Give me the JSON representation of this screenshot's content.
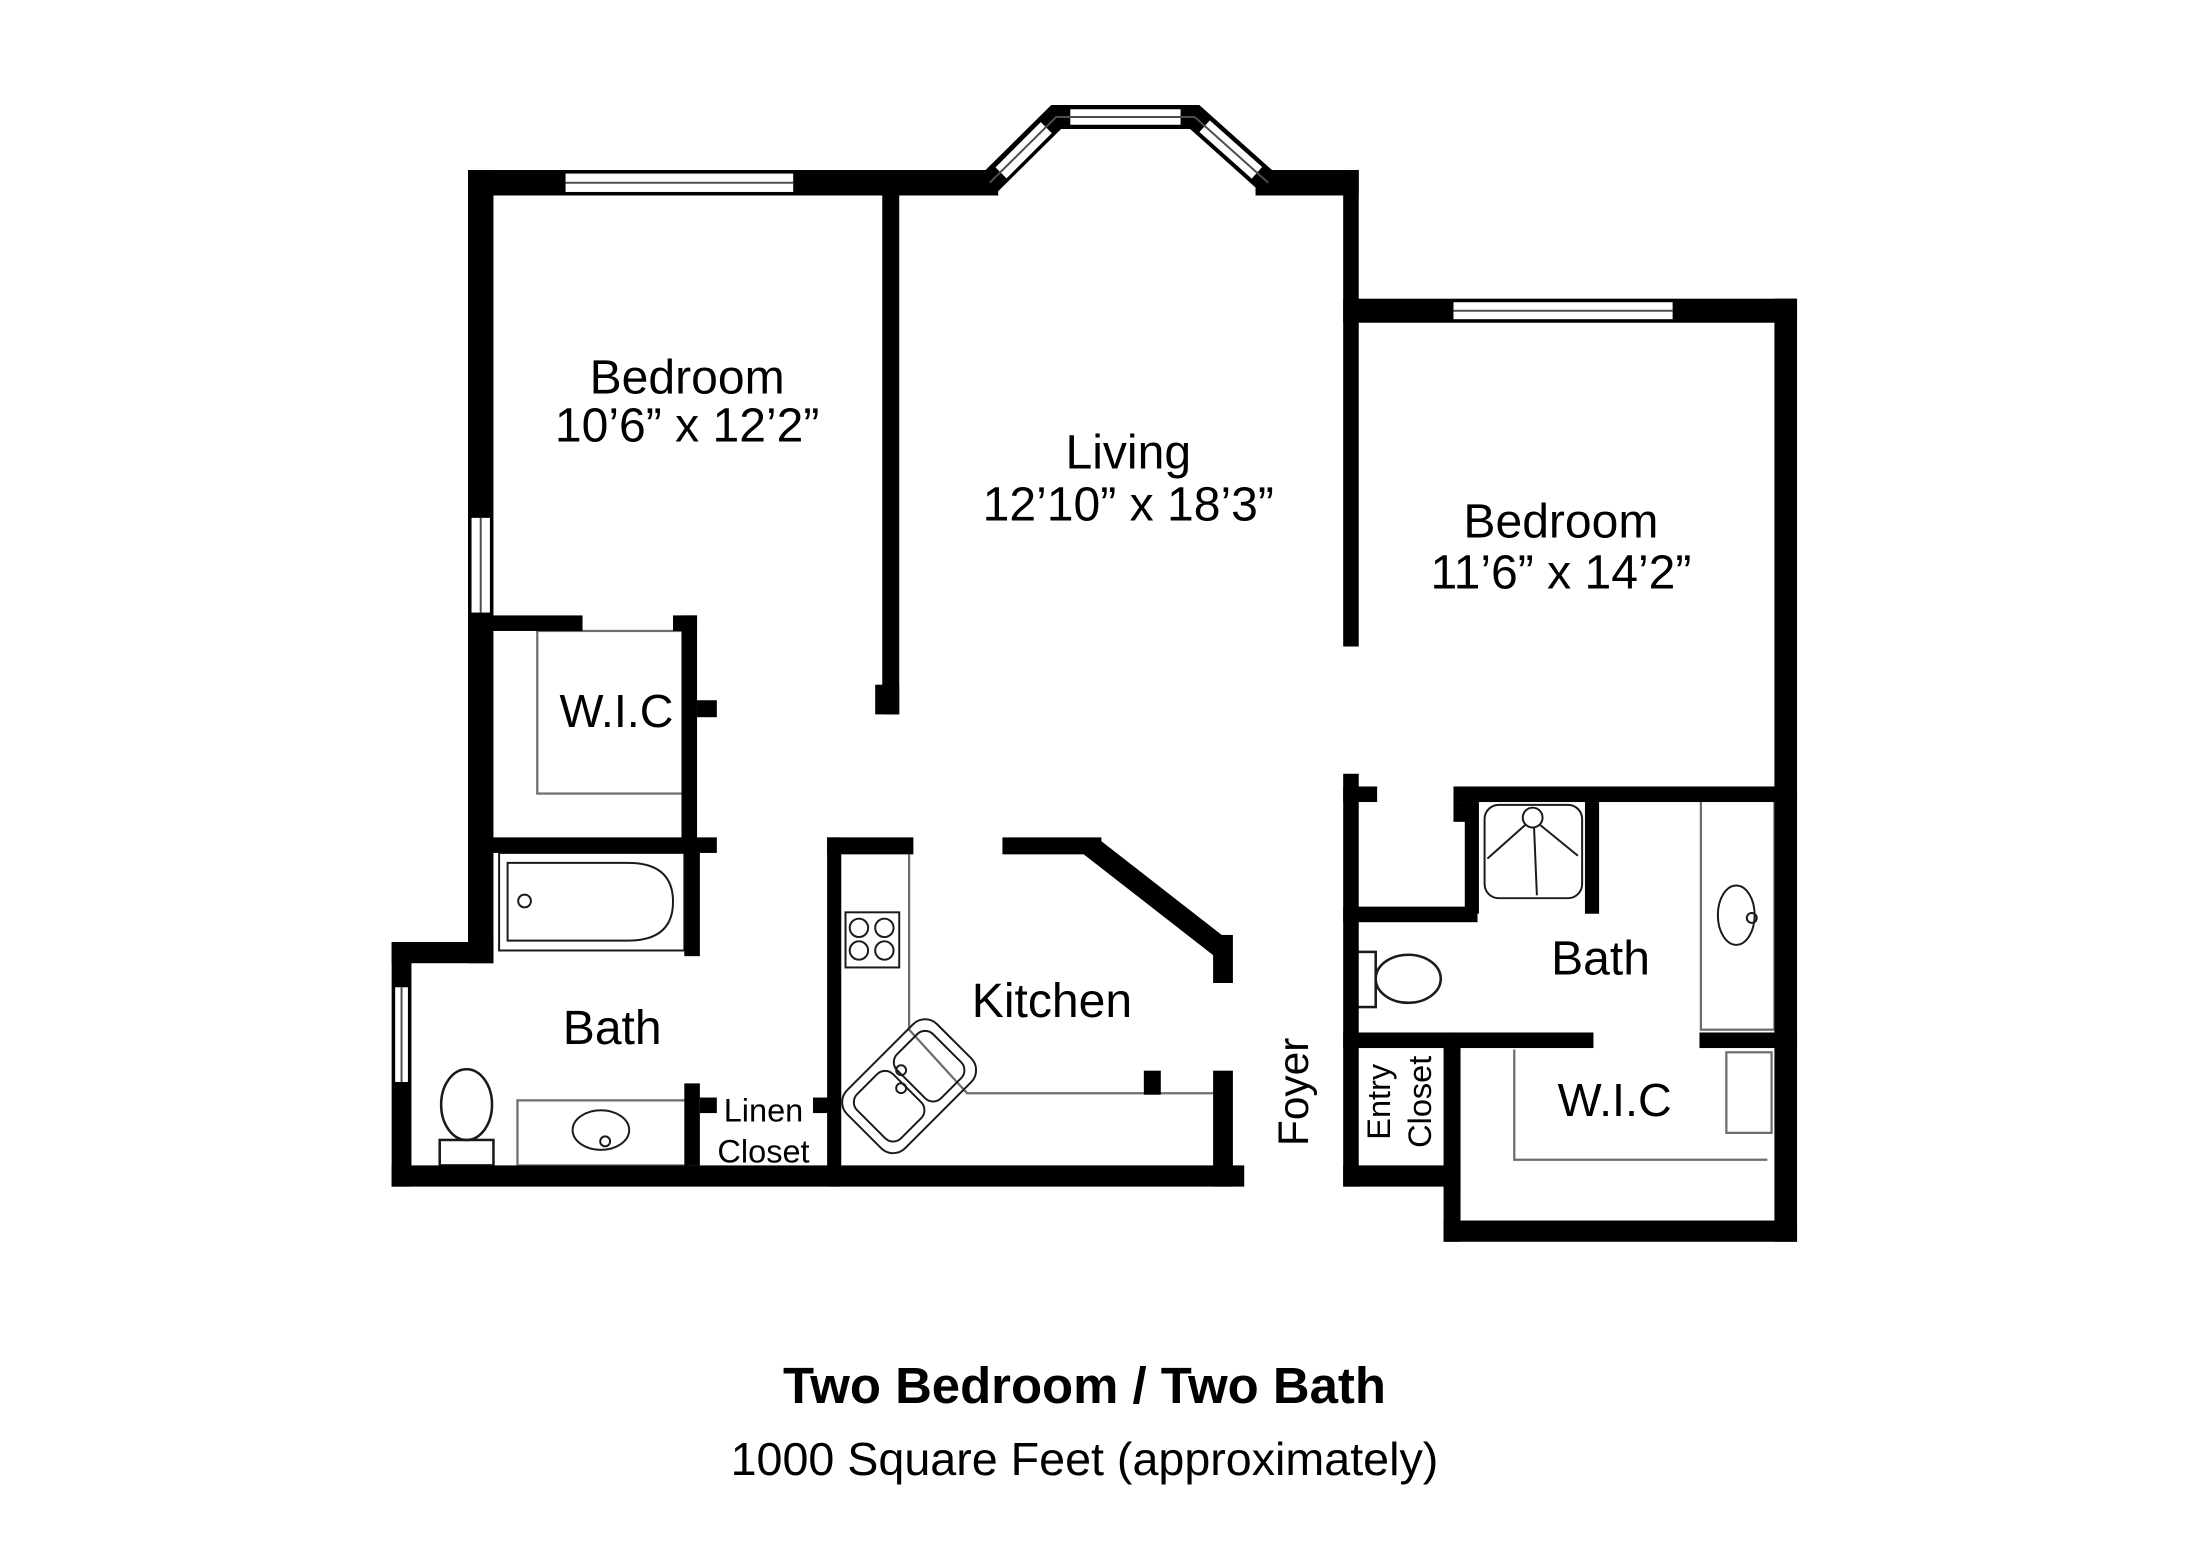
{
  "title": {
    "line1": "Two Bedroom / Two Bath",
    "line2": "1000 Square Feet (approximately)"
  },
  "rooms": {
    "bedroom1": {
      "name": "Bedroom",
      "dimensions": "10’6” x 12’2”"
    },
    "living": {
      "name": "Living",
      "dimensions": "12’10” x 18’3”"
    },
    "bedroom2": {
      "name": "Bedroom",
      "dimensions": "11’6” x 14’2”"
    },
    "wic1": {
      "name": "W.I.C"
    },
    "bath1": {
      "name": "Bath"
    },
    "linen_closet": {
      "line1": "Linen",
      "line2": "Closet"
    },
    "kitchen": {
      "name": "Kitchen"
    },
    "foyer": {
      "name": "Foyer"
    },
    "entry_closet": {
      "line1": "Entry",
      "line2": "Closet"
    },
    "bath2": {
      "name": "Bath"
    },
    "wic2": {
      "name": "W.I.C"
    }
  },
  "colors": {
    "wall": "#000000",
    "background": "#ffffff",
    "fixture_outline": "#1a1a1a",
    "light_line": "#6e6e6e"
  }
}
